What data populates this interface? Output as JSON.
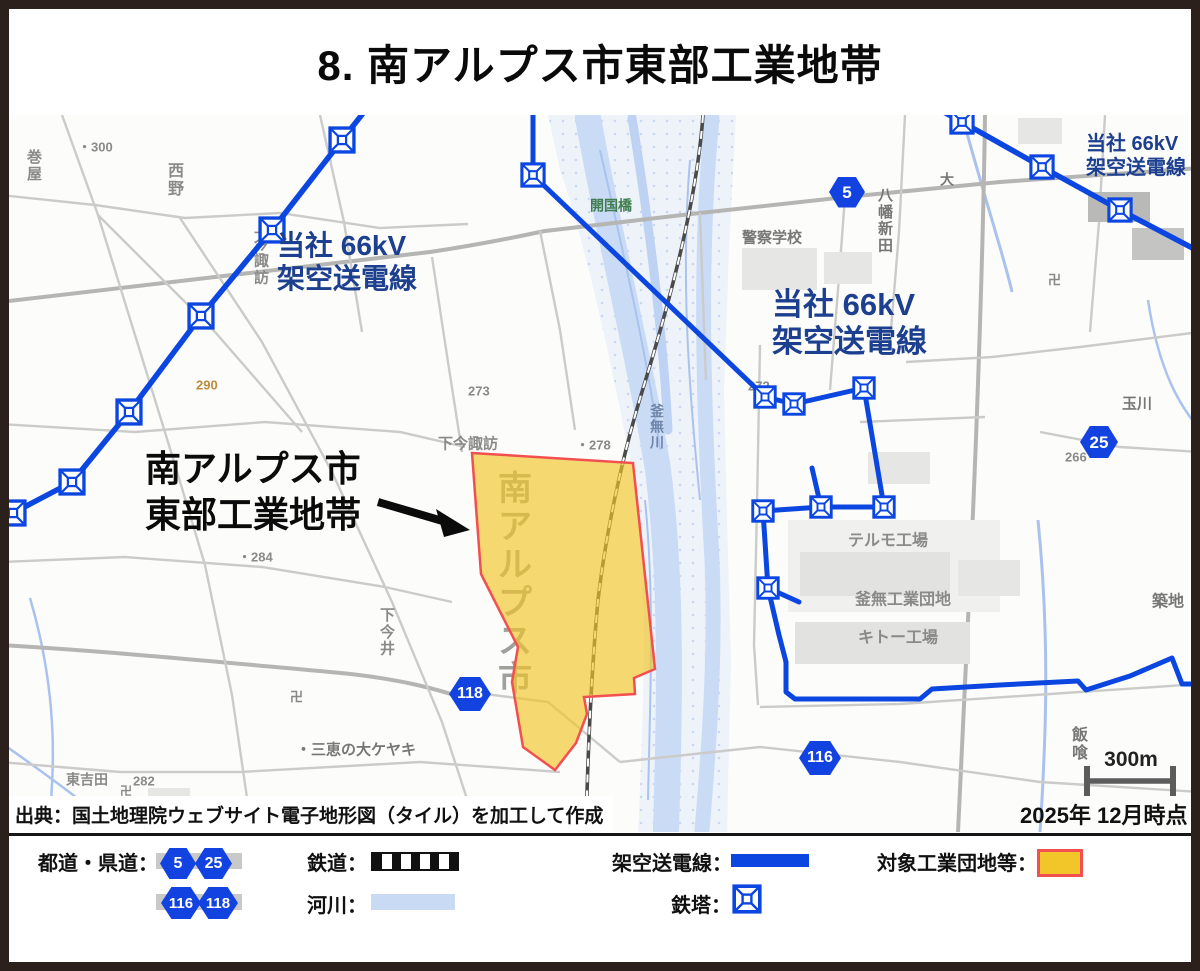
{
  "title": "8. 南アルプス市東部工業地帯",
  "map": {
    "labels": {
      "industrial_zone": [
        "南アルプス市",
        "東部工業地帯"
      ],
      "powerline_left": [
        "当社 66kV",
        "架空送電線"
      ],
      "powerline_center": [
        "当社 66kV",
        "架空送電線"
      ],
      "powerline_topright": [
        "当社 66kV",
        "架空送電線"
      ]
    },
    "road_badges": [
      {
        "label": "5",
        "x": 847,
        "y": 192,
        "w": 36,
        "h": 31
      },
      {
        "label": "25",
        "x": 1099,
        "y": 442,
        "w": 38,
        "h": 32
      },
      {
        "label": "116",
        "x": 820,
        "y": 758,
        "w": 42,
        "h": 34
      },
      {
        "label": "118",
        "x": 470,
        "y": 694,
        "w": 42,
        "h": 34
      }
    ],
    "pylons": [
      [
        13,
        513,
        28
      ],
      [
        72,
        482,
        28
      ],
      [
        129,
        412,
        28
      ],
      [
        201,
        316,
        28
      ],
      [
        272,
        230,
        28
      ],
      [
        342,
        140,
        28
      ],
      [
        533,
        175,
        26
      ],
      [
        765,
        397,
        24
      ],
      [
        794,
        404,
        24
      ],
      [
        864,
        388,
        24
      ],
      [
        884,
        507,
        24
      ],
      [
        821,
        507,
        24
      ],
      [
        763,
        511,
        24
      ],
      [
        768,
        588,
        24
      ],
      [
        962,
        122,
        26
      ],
      [
        1042,
        167,
        26
      ],
      [
        1120,
        210,
        26
      ]
    ],
    "base_labels": [
      {
        "t": "巻屋",
        "x": 27,
        "y": 152,
        "v": true,
        "c": "#8a8a8a",
        "s": 15
      },
      {
        "t": "・300",
        "x": 78,
        "y": 142,
        "c": "#8a8a8a",
        "s": 13
      },
      {
        "t": "西野",
        "x": 168,
        "y": 166,
        "v": true,
        "c": "#8a8a8a",
        "s": 16
      },
      {
        "t": "上今諏訪",
        "x": 254,
        "y": 222,
        "v": true,
        "c": "#8a8a8a",
        "s": 15
      },
      {
        "t": "290",
        "x": 196,
        "y": 380,
        "c": "#bd8a3e",
        "s": 13
      },
      {
        "t": "273",
        "x": 468,
        "y": 386,
        "c": "#8a8a8a",
        "s": 13
      },
      {
        "t": "下今諏訪",
        "x": 438,
        "y": 438,
        "c": "#8a8a8a",
        "s": 15
      },
      {
        "t": "開国橋",
        "x": 590,
        "y": 200,
        "c": "#3f7d4e",
        "s": 14
      },
      {
        "t": "警察学校",
        "x": 742,
        "y": 232,
        "c": "#777777",
        "s": 15
      },
      {
        "t": "八幡新田",
        "x": 878,
        "y": 190,
        "v": true,
        "c": "#777777",
        "s": 15
      },
      {
        "t": "大",
        "x": 940,
        "y": 174,
        "c": "#777777",
        "s": 14
      },
      {
        "t": "272",
        "x": 748,
        "y": 381,
        "c": "#8a8a8a",
        "s": 13
      },
      {
        "t": "・278",
        "x": 576,
        "y": 440,
        "c": "#8a8a8a",
        "s": 13
      },
      {
        "t": "釜無川",
        "x": 650,
        "y": 406,
        "v": true,
        "c": "#6f86a8",
        "s": 14
      },
      {
        "t": "玉川",
        "x": 1122,
        "y": 398,
        "c": "#777777",
        "s": 15
      },
      {
        "t": "266",
        "x": 1065,
        "y": 452,
        "c": "#8a8a8a",
        "s": 13
      },
      {
        "t": "南アルプス市",
        "x": 498,
        "y": 476,
        "v": true,
        "c": "#a0a09b",
        "s": 34
      },
      {
        "t": "・284",
        "x": 238,
        "y": 552,
        "c": "#8a8a8a",
        "s": 13
      },
      {
        "t": "下今井",
        "x": 380,
        "y": 610,
        "v": true,
        "c": "#8a8a8a",
        "s": 15
      },
      {
        "t": "テルモ工場",
        "x": 848,
        "y": 535,
        "c": "#8a8a8a",
        "s": 16
      },
      {
        "t": "釜無工業団地",
        "x": 855,
        "y": 594,
        "c": "#8a8a8a",
        "s": 16
      },
      {
        "t": "キトー工場",
        "x": 858,
        "y": 632,
        "c": "#8a8a8a",
        "s": 16
      },
      {
        "t": "築地",
        "x": 1152,
        "y": 596,
        "c": "#777777",
        "s": 16
      },
      {
        "t": "飯喰",
        "x": 1072,
        "y": 730,
        "v": true,
        "c": "#777777",
        "s": 16
      },
      {
        "t": "東吉田",
        "x": 66,
        "y": 774,
        "c": "#8a8a8a",
        "s": 14
      },
      {
        "t": "282",
        "x": 133,
        "y": 776,
        "c": "#8a8a8a",
        "s": 13
      },
      {
        "t": "・三恵の大ケヤキ",
        "x": 296,
        "y": 744,
        "c": "#777777",
        "s": 15
      },
      {
        "t": "卍",
        "x": 290,
        "y": 692,
        "c": "#888888",
        "s": 13
      },
      {
        "t": "卍",
        "x": 1048,
        "y": 275,
        "c": "#888888",
        "s": 13
      },
      {
        "t": "卍",
        "x": 120,
        "y": 786,
        "c": "#888888",
        "s": 12
      }
    ],
    "scale_label": "300m",
    "date_note": "2025年 12月時点",
    "source_note": "出典：国土地理院ウェブサイト電子地形図（タイル）を加工して作成"
  },
  "legend": {
    "roads_label": "都道・県道：",
    "badges": [
      "5",
      "25",
      "116",
      "118"
    ],
    "railway_label": "鉄道：",
    "river_label": "河川：",
    "powerline_label": "架空送電線：",
    "pylon_label": "鉄塔：",
    "industrial_label": "対象工業団地等："
  },
  "colors": {
    "powerline": "#0b46e0",
    "badge": "#1243e0",
    "navy": "#1d3f8f",
    "river": "#c9daf5",
    "industrial": "#f2c628",
    "indborder": "#f25050",
    "frame": "#2b201c"
  }
}
